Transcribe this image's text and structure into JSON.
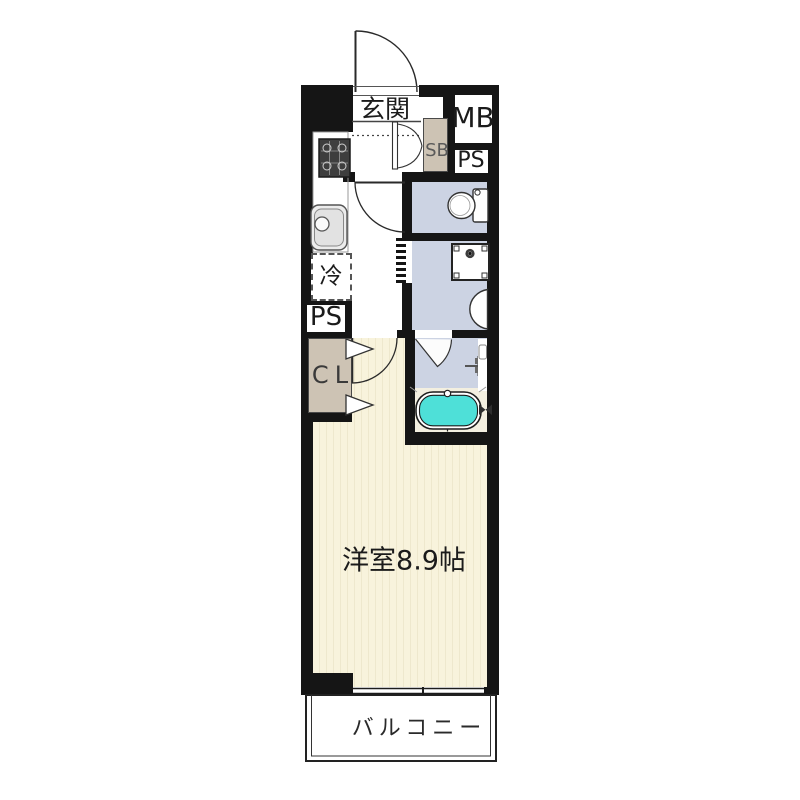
{
  "floorplan": {
    "labels": {
      "entrance": "玄関",
      "meter_box": "MB",
      "pipe_space_upper": "PS",
      "shoe_box": "SB",
      "refrigerator": "冷",
      "pipe_space_lower": "PS",
      "closet": "CL",
      "main_room": "洋室8.9帖",
      "balcony": "バルコニー"
    },
    "colors": {
      "wall": "#151515",
      "wet-area": "#ccd3e3",
      "storage": "#cdc3b4",
      "room": "#f8f3dc",
      "room-stripe": "#eee8cd",
      "bathtub": "#4ee0d8",
      "bath-floor": "#f3efe0"
    }
  }
}
